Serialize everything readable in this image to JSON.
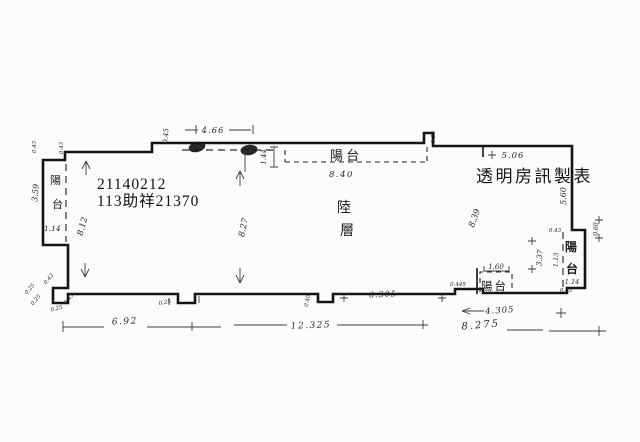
{
  "paper": {
    "background": "#fcfcfa",
    "ink": "#141414"
  },
  "stamps": {
    "doc_number": "21140212",
    "case_ref": "113助祥21370",
    "publisher": "透明房訊製表"
  },
  "floor": {
    "char1": "陸",
    "char2": "層",
    "label": "陸層"
  },
  "balcony": {
    "top_label": "陽 台",
    "left_char1": "陽",
    "left_char2": "台",
    "right_char1": "陽",
    "right_char2": "台",
    "bottom_label": "陽台"
  },
  "dims": {
    "top_balcony_width": "8.40",
    "top_step": "0.45",
    "top_left": "4.66",
    "top_depth": "1.44",
    "top_bump": "0.25",
    "top_right": "5.06",
    "right_wall": "5.60",
    "left_wall": "8.12",
    "left_balcony_height": "3.59",
    "left_balcony_bottom": "1.14",
    "mid_height": "8.27",
    "right_height": "8.39",
    "bottom_left": "6.92",
    "bottom_total": "12.325",
    "bottom_inner": "6.305",
    "bottom_right": "4.305",
    "bottom_right_total": "8.275",
    "right_balcony_outer": "3.37",
    "right_balcony_inner": "1.13",
    "right_balcony_bottom": "1.14",
    "right_balcony_depth": "0.60",
    "small_balcony_width": "1.60",
    "small_balcony_offset": "0.445"
  },
  "ticks": {
    "tl_a": "0.43",
    "tl_b": "0.43",
    "bl_a": "0.43",
    "bl_b": "0.25",
    "bl_c": "0.25",
    "bl_d": "0.43",
    "bl_e": "0.25",
    "n1": "0.25",
    "n2": "0.40",
    "rb_top": "0.43",
    "rb_bottom": "0.45"
  }
}
